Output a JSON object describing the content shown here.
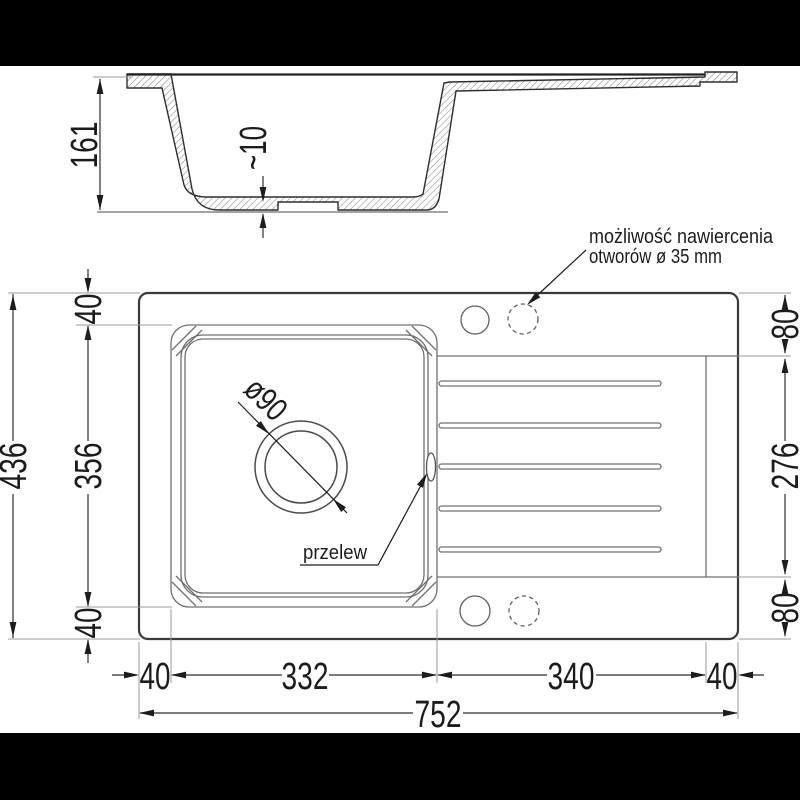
{
  "annotation": {
    "line1": "możliwość nawiercenia",
    "line2": "otworów ø 35 mm"
  },
  "labels": {
    "overflow": "przelew",
    "drain_diameter": "ø90"
  },
  "section_dims": {
    "depth": "161",
    "bottom_thickness": "~10"
  },
  "plan_dims": {
    "height_total": "436",
    "left_top": "40",
    "left_middle": "356",
    "left_bottom": "40",
    "right_top": "80",
    "right_middle": "276",
    "right_bottom": "80",
    "bottom_left_margin": "40",
    "bottom_bowl": "332",
    "bottom_drainer": "340",
    "bottom_right_margin": "40",
    "width_total": "752"
  },
  "colors": {
    "background": "#ffffff",
    "letterbox_bars": "#000000",
    "line_dark": "#2d2d2d",
    "line_medium": "#6e6e6e",
    "line_light": "#9a9a9a",
    "hatch": "#7a7a7a"
  }
}
